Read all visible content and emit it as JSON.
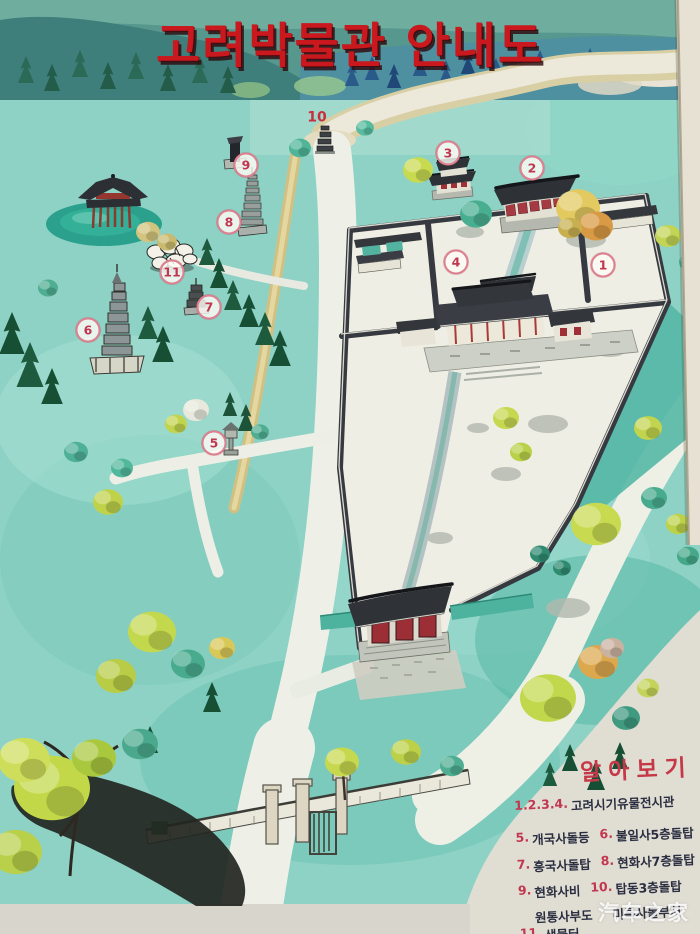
{
  "photo": {
    "watermark": "汽车之家",
    "frame_edge_color": "#e6e1d2"
  },
  "map": {
    "title": "고려박물관 안내도",
    "title_color": "#c9191f",
    "legend": {
      "title": "알아보기",
      "items": [
        {
          "num": "1.2.3.4.",
          "label": "고려시기유물전시관"
        },
        {
          "num": "5.",
          "label": "개국사돌등"
        },
        {
          "num": "6.",
          "label": "불일사5층돌탑"
        },
        {
          "num": "7.",
          "label": "흥국사돌탑"
        },
        {
          "num": "8.",
          "label": "현화사7층돌탑"
        },
        {
          "num": "9.",
          "label": "현화사비"
        },
        {
          "num": "10.",
          "label": "탑동3층돌탑"
        },
        {
          "num": "",
          "label": "원통사부도"
        },
        {
          "num": "",
          "label": "미륵사돌부처"
        },
        {
          "num": "11.",
          "label": "샘물터"
        }
      ]
    },
    "markers": [
      {
        "id": "1",
        "site": "고려시기유물전시관"
      },
      {
        "id": "2",
        "site": "고려시기유물전시관"
      },
      {
        "id": "3",
        "site": "고려시기유물전시관"
      },
      {
        "id": "4",
        "site": "고려시기유물전시관"
      },
      {
        "id": "5",
        "site": "개국사돌등"
      },
      {
        "id": "6",
        "site": "불일사5층돌탑"
      },
      {
        "id": "7",
        "site": "흥국사돌탑"
      },
      {
        "id": "8",
        "site": "현화사7층돌탑"
      },
      {
        "id": "9",
        "site": "현화사비"
      },
      {
        "id": "10",
        "site": "탑동3층돌탑"
      },
      {
        "id": "11",
        "site": "샘물터"
      }
    ],
    "colors": {
      "ground_teal": "#8ed2c5",
      "courtyard": "#efeee4",
      "roof_dark": "#2f3338",
      "accent_red": "#a63a42",
      "tree_yellow_green": "#c6d84e",
      "tree_teal": "#4fae92",
      "tree_conifer": "#1e5a3e",
      "river": "#ece8da",
      "road": "#eef0e8",
      "legend_number_red": "#c23750",
      "legend_text": "#2a2e40"
    }
  }
}
